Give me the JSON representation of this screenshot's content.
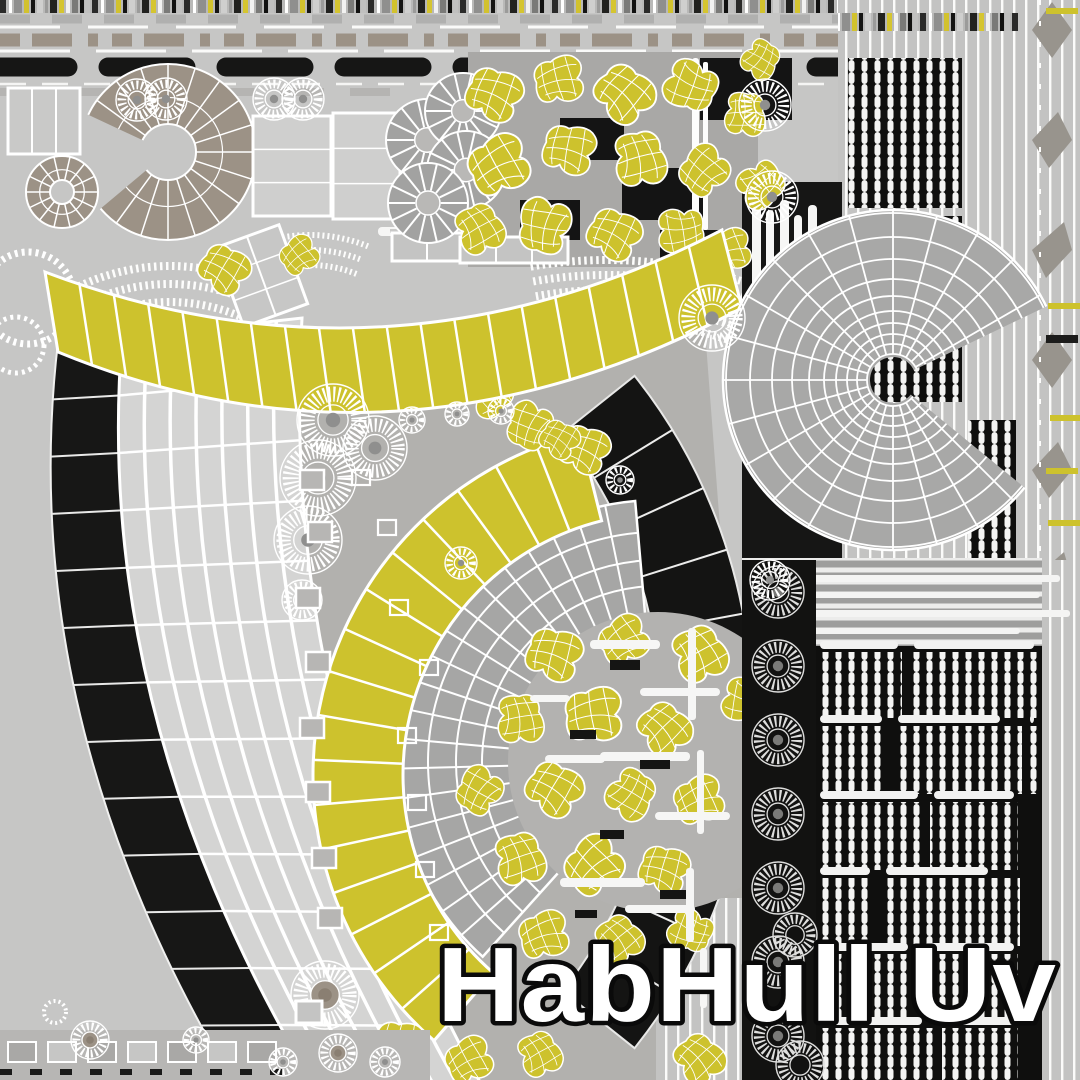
{
  "watermark": {
    "label": "HabHull Uv"
  },
  "palette": {
    "background": "#c6c6c5",
    "light_panel": "#d4d4d3",
    "mid_gray": "#aeadab",
    "fan_gray": "#a8a8a7",
    "taupe": "#9c9286",
    "yellow": "#cdc22d",
    "dark": "#161615",
    "white": "#ffffff",
    "watermark_fill": "#ffffff",
    "watermark_outline": "#0a0a0a"
  }
}
